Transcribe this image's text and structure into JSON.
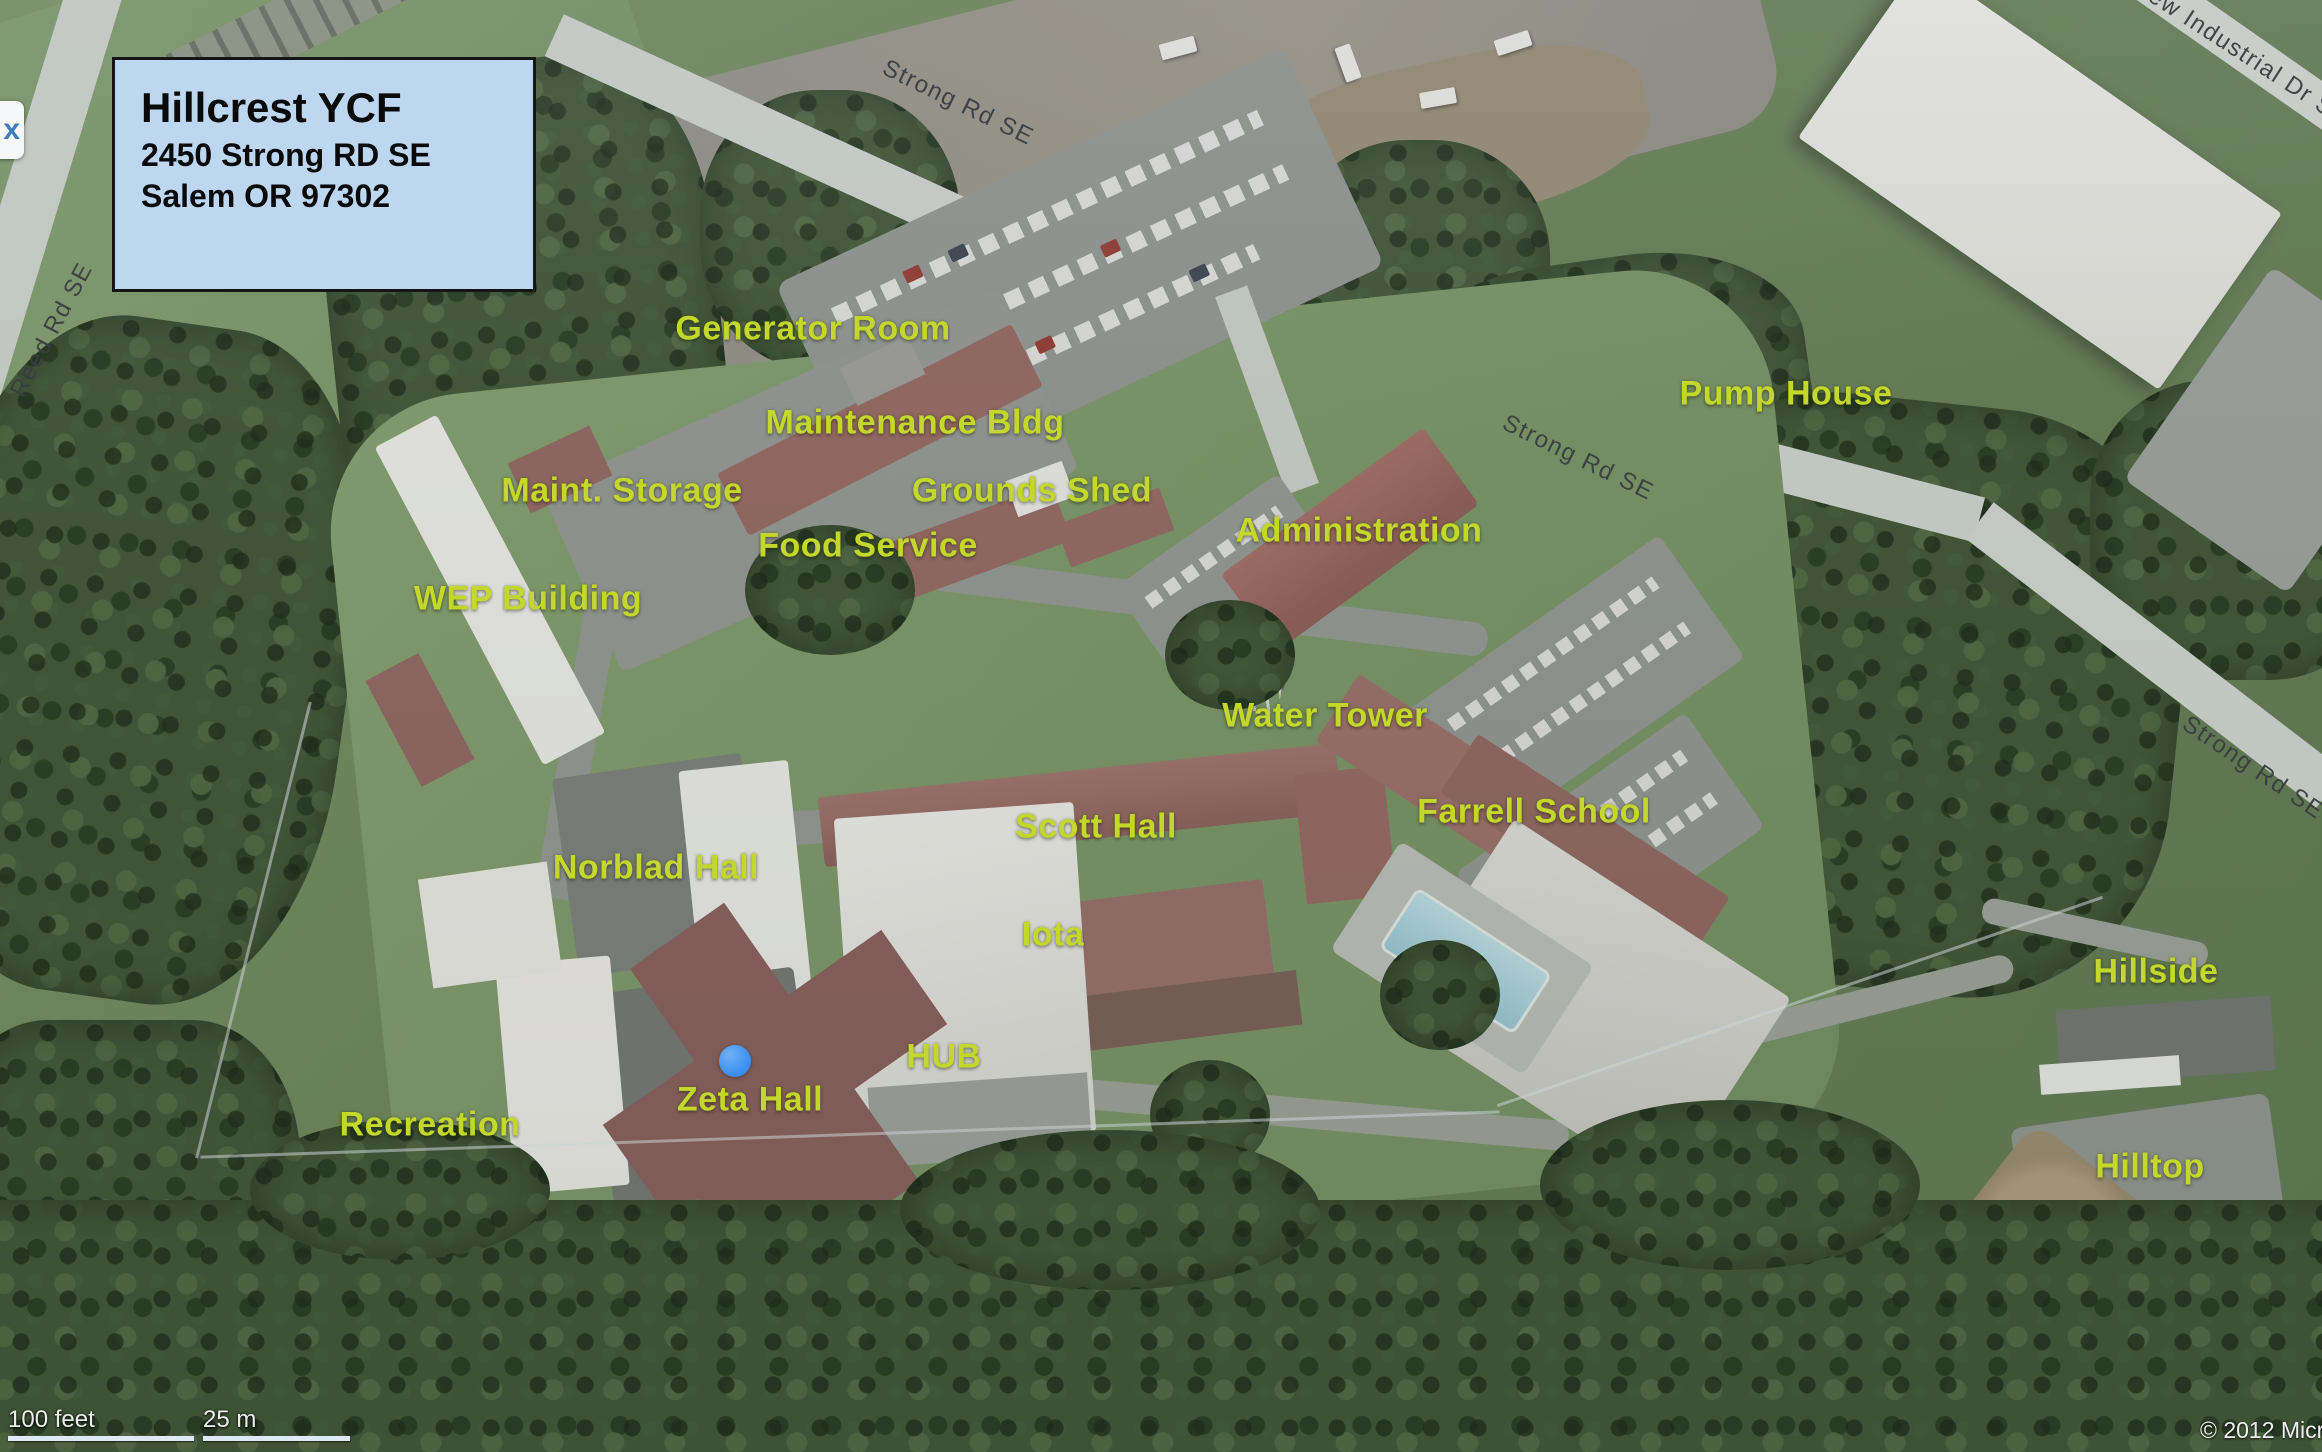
{
  "map": {
    "info_box": {
      "title": "Hillcrest YCF",
      "address_line1": "2450 Strong RD SE",
      "address_line2": "Salem OR 97302"
    },
    "close_button_label": "x",
    "place_labels": [
      {
        "id": "generator-room",
        "text": "Generator Room",
        "x": 813,
        "y": 329
      },
      {
        "id": "maintenance-bldg",
        "text": "Maintenance Bldg",
        "x": 915,
        "y": 423
      },
      {
        "id": "maint-storage",
        "text": "Maint. Storage",
        "x": 622,
        "y": 491
      },
      {
        "id": "grounds-shed",
        "text": "Grounds Shed",
        "x": 1032,
        "y": 491
      },
      {
        "id": "food-service",
        "text": "Food Service",
        "x": 868,
        "y": 546
      },
      {
        "id": "wep-building",
        "text": "WEP Building",
        "x": 528,
        "y": 599
      },
      {
        "id": "administration",
        "text": "Administration",
        "x": 1359,
        "y": 531
      },
      {
        "id": "pump-house",
        "text": "Pump House",
        "x": 1786,
        "y": 394
      },
      {
        "id": "water-tower",
        "text": "Water Tower",
        "x": 1325,
        "y": 716
      },
      {
        "id": "scott-hall",
        "text": "Scott Hall",
        "x": 1096,
        "y": 827
      },
      {
        "id": "farrell-school",
        "text": "Farrell School",
        "x": 1534,
        "y": 812
      },
      {
        "id": "norblad-hall",
        "text": "Norblad Hall",
        "x": 656,
        "y": 868
      },
      {
        "id": "iota",
        "text": "Iota",
        "x": 1053,
        "y": 935
      },
      {
        "id": "hub",
        "text": "HUB",
        "x": 944,
        "y": 1057
      },
      {
        "id": "zeta-hall",
        "text": "Zeta Hall",
        "x": 750,
        "y": 1100
      },
      {
        "id": "recreation",
        "text": "Recreation",
        "x": 430,
        "y": 1125
      },
      {
        "id": "hillside",
        "text": "Hillside",
        "x": 2156,
        "y": 972
      },
      {
        "id": "hilltop",
        "text": "Hilltop",
        "x": 2150,
        "y": 1167
      }
    ],
    "road_labels": [
      {
        "id": "strong-rd-top",
        "text": "Strong Rd SE",
        "x": 958,
        "y": 103,
        "angle": 26
      },
      {
        "id": "strong-rd-mid",
        "text": "Strong Rd SE",
        "x": 1578,
        "y": 458,
        "angle": 26
      },
      {
        "id": "strong-rd-right",
        "text": "Strong Rd SE",
        "x": 2253,
        "y": 768,
        "angle": 34
      },
      {
        "id": "reed-rd",
        "text": "Reed Rd SE",
        "x": 52,
        "y": 330,
        "angle": -62
      },
      {
        "id": "industrial-dr",
        "text": "view Industrial Dr SE",
        "x": 2240,
        "y": 52,
        "angle": 33
      }
    ],
    "marker": {
      "x": 735,
      "y": 1061
    },
    "scale_bar": {
      "feet_label": "100 feet",
      "metric_label": "25 m"
    },
    "copyright": "© 2012 Micro"
  },
  "colors": {
    "label_yellow": "#c3d82b",
    "info_box_bg": "#bdd7f1",
    "marker_blue": "#3f93f2",
    "road_text": "#393e41"
  }
}
